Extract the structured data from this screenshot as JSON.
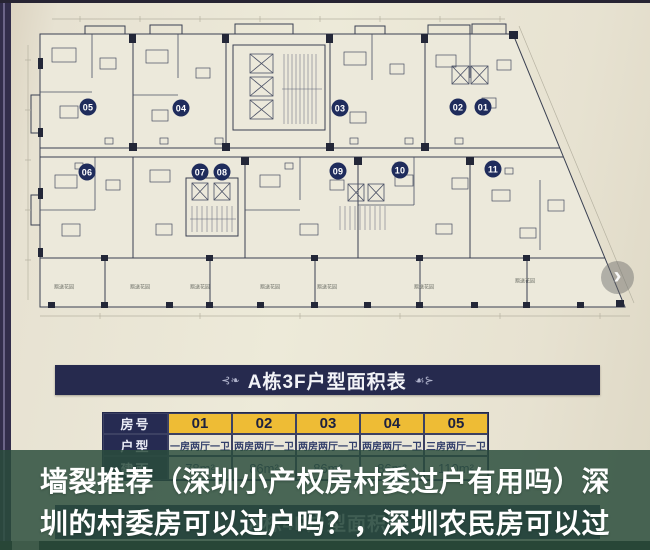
{
  "carousel": {
    "next_icon": "›"
  },
  "plan": {
    "unit_badges": [
      "05",
      "04",
      "03",
      "02",
      "01",
      "06",
      "07",
      "08",
      "09",
      "10",
      "11"
    ],
    "terrace_label": "赠送花园"
  },
  "area_table": {
    "ornament_left": "⊰❧",
    "ornament_right": "☙⊱",
    "title": "A栋3F户型面积表",
    "room_label": "房号",
    "room_numbers": [
      "01",
      "02",
      "03",
      "04",
      "05"
    ],
    "type_label": "户型",
    "types": [
      "一房两厅一卫",
      "两房两厅一卫",
      "两房两厅一卫",
      "两房两厅一卫",
      "三房两厅一卫"
    ],
    "area_label": "建面",
    "areas": [
      "78m²",
      "86m²",
      "86m²",
      "86m²",
      "110m²"
    ]
  },
  "next_section": {
    "title": "A栋4F户型面积表"
  },
  "caption": {
    "line1": "墙裂推荐（深圳小产权房村委过户有用吗）深",
    "line2": "圳的村委房可以过户吗？，深圳农民房可以过"
  },
  "colors": {
    "paper": "#ece9db",
    "navy_bar": "#262a4e",
    "badge_navy": "#1f2c5c",
    "cell_yellow": "#eebc35",
    "overlay_green": "#2a4c3c",
    "caption_text": "#ffffff"
  }
}
